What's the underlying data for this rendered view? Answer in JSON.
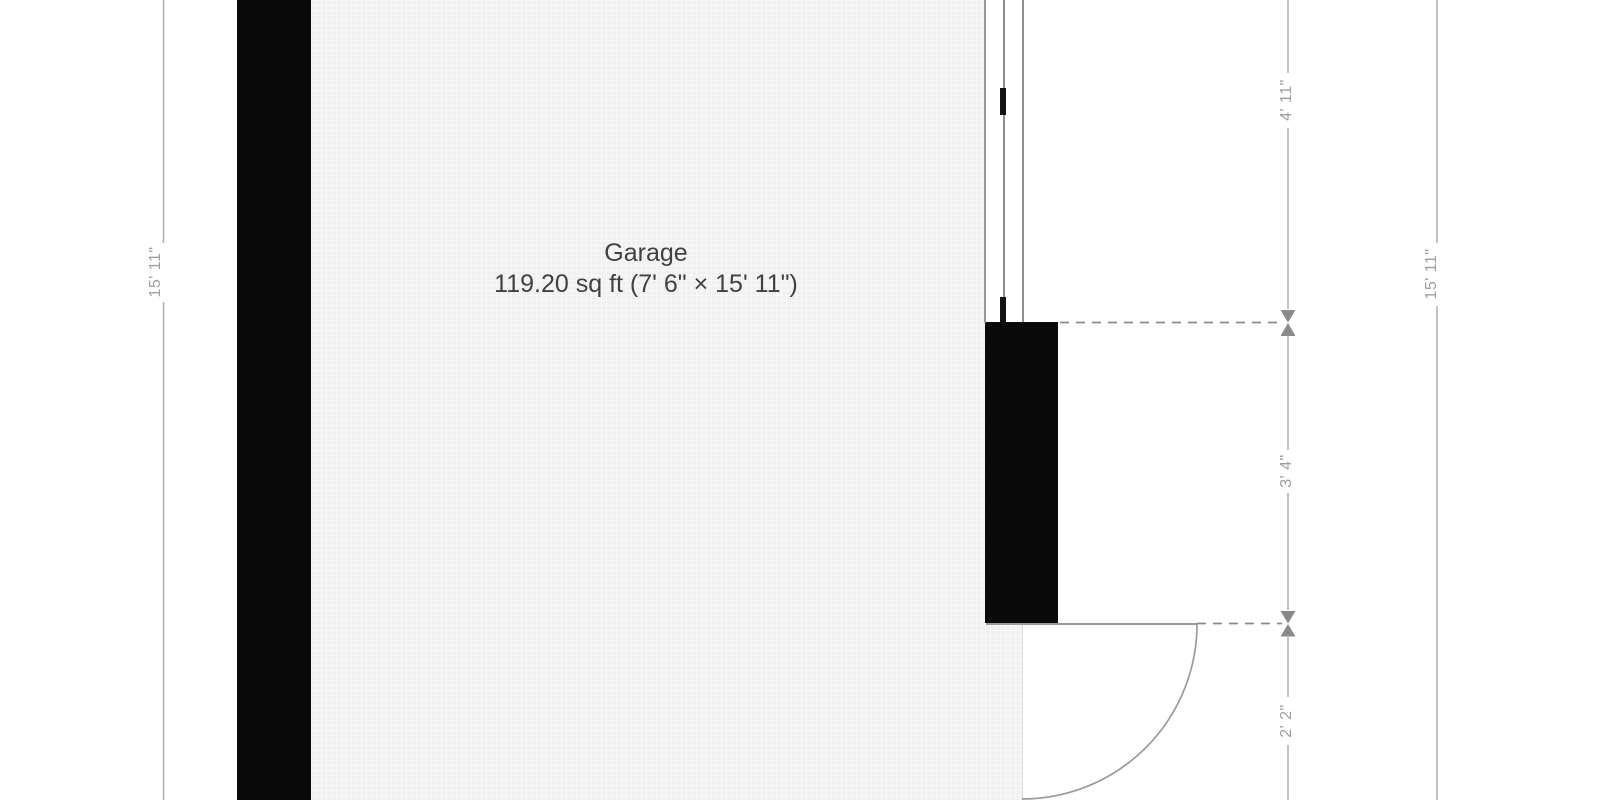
{
  "plan": {
    "room": {
      "name": "Garage",
      "area": "119.20 sq ft (7' 6\" × 15' 11\")"
    },
    "dimensions": {
      "left_wall_height": "15' 11\"",
      "right_total_height": "15' 11\"",
      "window_section": "4' 11\"",
      "wall_section": "3' 4\"",
      "door_section": "2' 2\""
    },
    "colors": {
      "wall": "#0a0a0a",
      "floor": "#f0f0f0",
      "dimension_line": "#b2b2b2",
      "dimension_text": "#9e9e9e",
      "marker": "#8a8a8a"
    }
  }
}
